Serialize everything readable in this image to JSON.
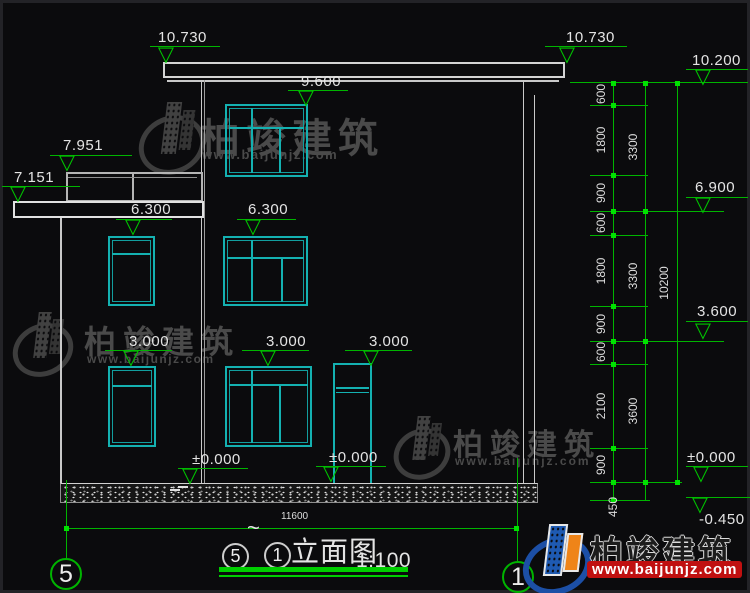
{
  "drawing_title": {
    "from_axis": "5",
    "tilde": "~",
    "to_axis": "1",
    "name": "立面图",
    "scale": "1:100"
  },
  "axis_bubbles": {
    "left": "5",
    "right": "1"
  },
  "elevation_markers": [
    {
      "label": "10.730"
    },
    {
      "label": "10.730"
    },
    {
      "label": "10.200"
    },
    {
      "label": "9.600"
    },
    {
      "label": "7.951"
    },
    {
      "label": "7.151"
    },
    {
      "label": "6.300"
    },
    {
      "label": "6.300"
    },
    {
      "label": "6.900"
    },
    {
      "label": "3.600"
    },
    {
      "label": "3.000"
    },
    {
      "label": "3.000"
    },
    {
      "label": "3.000"
    },
    {
      "label": "±0.000"
    },
    {
      "label": "±0.000"
    },
    {
      "label": "±0.000"
    },
    {
      "label": "-0.450"
    }
  ],
  "dim_chain_small": [
    {
      "v": "600"
    },
    {
      "v": "1800"
    },
    {
      "v": "900"
    },
    {
      "v": "600"
    },
    {
      "v": "1800"
    },
    {
      "v": "900"
    },
    {
      "v": "600"
    },
    {
      "v": "2100"
    },
    {
      "v": "900"
    },
    {
      "v": "450"
    }
  ],
  "dim_chain_mid": [
    {
      "v": "3300"
    },
    {
      "v": "3300"
    },
    {
      "v": "3600"
    }
  ],
  "dim_total": "10200",
  "dim_width": "11600",
  "watermark": {
    "brand": "柏竣建筑",
    "url": "www.baijunjz.com"
  },
  "colors": {
    "line_green": "#00b400",
    "cad_cyan": "#14b1b1",
    "wall_white": "#cfcfcf",
    "url_red": "#c01010",
    "logo_blue": "#1e5ab2",
    "logo_orange": "#ef8418"
  }
}
